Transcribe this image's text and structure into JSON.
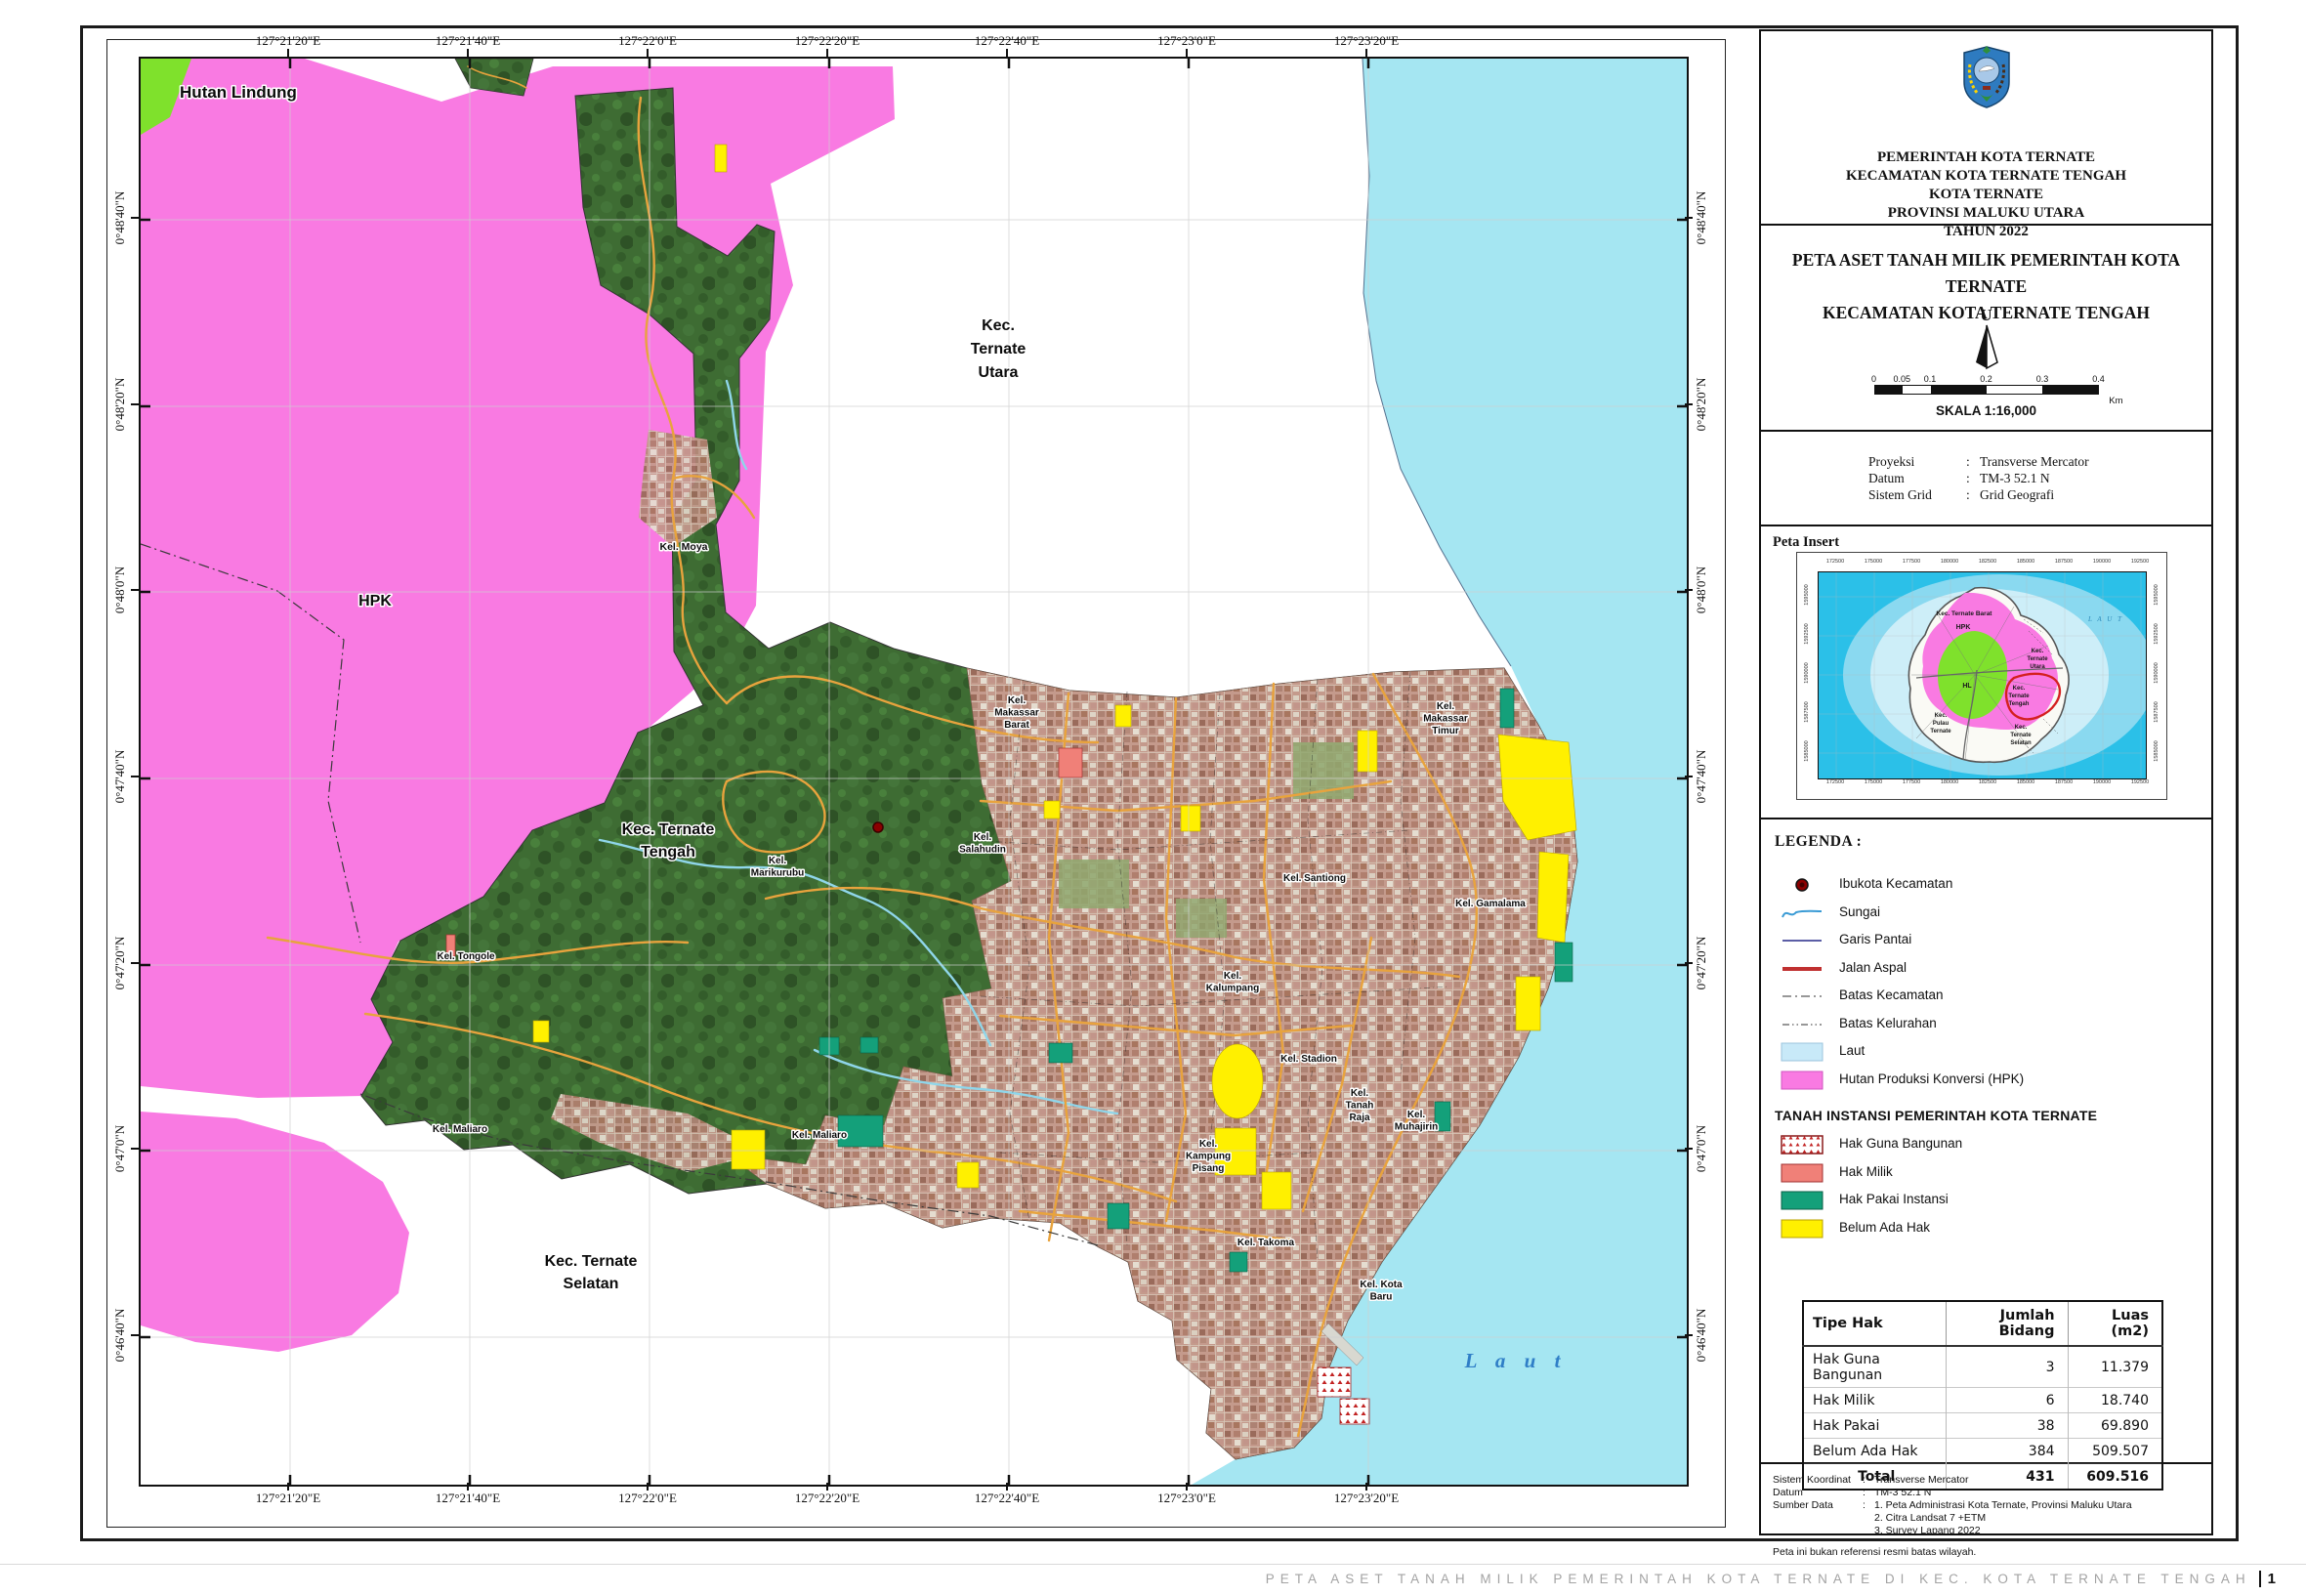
{
  "header": {
    "lines": [
      "PEMERINTAH KOTA TERNATE",
      "KECAMATAN KOTA TERNATE TENGAH",
      "KOTA TERNATE",
      "PROVINSI MALUKU UTARA",
      "TAHUN 2022"
    ]
  },
  "title": {
    "line1": "PETA ASET TANAH MILIK PEMERINTAH KOTA TERNATE",
    "line2": "KECAMATAN KOTA TERNATE TENGAH"
  },
  "north": {
    "label": "U"
  },
  "scalebar": {
    "ticks": [
      "0",
      "0.05",
      "0.1",
      "0.2",
      "0.3",
      "0.4"
    ],
    "unit": "Km",
    "skala": "SKALA 1:16,000"
  },
  "projection": {
    "rows": [
      {
        "label": "Proyeksi",
        "value": "Transverse Mercator"
      },
      {
        "label": "Datum",
        "value": "TM-3 52.1 N"
      },
      {
        "label": "Sistem Grid",
        "value": "Grid Geografi"
      }
    ]
  },
  "inset": {
    "heading": "Peta Insert",
    "sea_label": "L A U T",
    "x_ticks": [
      "172500",
      "175000",
      "177500",
      "180000",
      "182500",
      "185000",
      "187500",
      "190000",
      "192500"
    ],
    "y_ticks": [
      "1595000",
      "1592500",
      "1590000",
      "1587500",
      "1585000"
    ],
    "labels": [
      {
        "lines": [
          "Kec. Ternate Barat"
        ],
        "x": 149,
        "y": 44,
        "size": 6.5,
        "bold": true
      },
      {
        "lines": [
          "HPK"
        ],
        "x": 148,
        "y": 58,
        "size": 7,
        "bold": true
      },
      {
        "lines": [
          "Kec.",
          "Ternate",
          "Utara"
        ],
        "x": 224,
        "y": 82,
        "size": 6,
        "bold": true
      },
      {
        "lines": [
          "HL"
        ],
        "x": 152,
        "y": 118,
        "size": 7,
        "bold": true
      },
      {
        "lines": [
          "Kec.",
          "Ternate",
          "Tengah"
        ],
        "x": 205,
        "y": 120,
        "size": 6,
        "bold": true
      },
      {
        "lines": [
          "Kec.",
          "Pulau",
          "Ternate"
        ],
        "x": 125,
        "y": 148,
        "size": 6,
        "bold": true
      },
      {
        "lines": [
          "Kec.",
          "Ternate",
          "Selatan"
        ],
        "x": 207,
        "y": 160,
        "size": 6,
        "bold": true
      }
    ]
  },
  "legend": {
    "heading": "LEGENDA :",
    "items": [
      {
        "label": "Ibukota Kecamatan",
        "sym": "point"
      },
      {
        "label": "Sungai",
        "sym": "river"
      },
      {
        "label": "Garis Pantai",
        "sym": "coast"
      },
      {
        "label": "Jalan Aspal",
        "sym": "road"
      },
      {
        "label": "Batas Kecamatan",
        "sym": "dash1"
      },
      {
        "label": "Batas Kelurahan",
        "sym": "dash2"
      },
      {
        "label": "Laut",
        "sym": "fill",
        "color": "#c8e9f8",
        "border": "#9bc4dd"
      },
      {
        "label": "Hutan Produksi Konversi (HPK)",
        "sym": "fill",
        "color": "#f97ae2",
        "border": "#d055c0"
      }
    ],
    "tanah_heading": "TANAH INSTANSI PEMERINTAH KOTA TERNATE",
    "tanah_items": [
      {
        "label": "Hak Guna Bangunan",
        "sym": "hgb",
        "color": "#ffffff",
        "border": "#8b1a1a"
      },
      {
        "label": "Hak Milik",
        "sym": "fill",
        "color": "#f08078",
        "border": "#a03030"
      },
      {
        "label": "Hak Pakai Instansi",
        "sym": "fill",
        "color": "#14a07a",
        "border": "#0a5f47"
      },
      {
        "label": "Belum Ada Hak",
        "sym": "fill",
        "color": "#fff000",
        "border": "#b8a000"
      }
    ]
  },
  "table": {
    "headers": [
      "Tipe Hak",
      "Jumlah Bidang",
      "Luas (m2)"
    ],
    "rows": [
      [
        "Hak Guna Bangunan",
        "3",
        "11.379"
      ],
      [
        "Hak Milik",
        "6",
        "18.740"
      ],
      [
        "Hak Pakai",
        "38",
        "69.890"
      ],
      [
        "Belum Ada Hak",
        "384",
        "509.507"
      ]
    ],
    "total": [
      "Total",
      "431",
      "609.516"
    ]
  },
  "info": {
    "rows": [
      {
        "label": "Sistem Koordinat",
        "value": "Transverse Mercator"
      },
      {
        "label": "Datum",
        "value": "TM-3 52.1 N"
      },
      {
        "label": "Sumber Data",
        "value": "1. Peta Administrasi Kota Ternate, Provinsi Maluku Utara\n2. Citra Landsat 7 +ETM\n3. Survey Lapang 2022"
      }
    ],
    "note": "Peta ini bukan referensi resmi batas wilayah."
  },
  "map": {
    "lon_labels": [
      "127°21'20\"E",
      "127°21'40\"E",
      "127°22'0\"E",
      "127°22'20\"E",
      "127°22'40\"E",
      "127°23'0\"E",
      "127°23'20\"E"
    ],
    "lat_labels": [
      "0°48'40\"N",
      "0°48'20\"N",
      "0°48'0\"N",
      "0°47'40\"N",
      "0°47'20\"N",
      "0°47'0\"N",
      "0°46'40\"N"
    ],
    "place_labels": [
      {
        "lines": [
          "Hutan Lindung"
        ],
        "x": 100,
        "y": 40,
        "size": 17,
        "bold": true
      },
      {
        "lines": [
          "HPK"
        ],
        "x": 240,
        "y": 560,
        "size": 16,
        "bold": true
      },
      {
        "lines": [
          "Kec.",
          "Ternate",
          "Utara"
        ],
        "x": 878,
        "y": 278,
        "size": 16,
        "bold": true,
        "lh": 24
      },
      {
        "lines": [
          "Kel. Moya"
        ],
        "x": 556,
        "y": 503,
        "size": 10.5
      },
      {
        "lines": [
          "Kec. Ternate",
          "Tengah"
        ],
        "x": 540,
        "y": 794,
        "size": 16,
        "bold": true,
        "lh": 23
      },
      {
        "lines": [
          "Kel.",
          "Marikurubu"
        ],
        "x": 652,
        "y": 824,
        "size": 10
      },
      {
        "lines": [
          "Kel.",
          "Salahudin"
        ],
        "x": 862,
        "y": 800,
        "size": 10
      },
      {
        "lines": [
          "Kel.",
          "Makassar",
          "Barat"
        ],
        "x": 897,
        "y": 660,
        "size": 10
      },
      {
        "lines": [
          "Kel. Santiong"
        ],
        "x": 1202,
        "y": 842,
        "size": 10
      },
      {
        "lines": [
          "Kel. Gamalama"
        ],
        "x": 1382,
        "y": 868,
        "size": 10
      },
      {
        "lines": [
          "Kel.",
          "Makassar",
          "Timur"
        ],
        "x": 1336,
        "y": 666,
        "size": 10
      },
      {
        "lines": [
          "Kel.",
          "Kalumpang"
        ],
        "x": 1118,
        "y": 942,
        "size": 10
      },
      {
        "lines": [
          "Kel. Stadion"
        ],
        "x": 1196,
        "y": 1027,
        "size": 10
      },
      {
        "lines": [
          "Kel.",
          "Tanah",
          "Raja"
        ],
        "x": 1248,
        "y": 1062,
        "size": 10
      },
      {
        "lines": [
          "Kel.",
          "Muhajirin"
        ],
        "x": 1306,
        "y": 1084,
        "size": 10
      },
      {
        "lines": [
          "Kel.",
          "Kampung",
          "Pisang"
        ],
        "x": 1093,
        "y": 1114,
        "size": 10
      },
      {
        "lines": [
          "Kel. Takoma"
        ],
        "x": 1152,
        "y": 1215,
        "size": 10
      },
      {
        "lines": [
          "Kel. Kota",
          "Baru"
        ],
        "x": 1270,
        "y": 1258,
        "size": 10
      },
      {
        "lines": [
          "Kel. Tongole"
        ],
        "x": 333,
        "y": 922,
        "size": 10
      },
      {
        "lines": [
          "Kel. Maliaro"
        ],
        "x": 327,
        "y": 1099,
        "size": 10
      },
      {
        "lines": [
          "Kel. Maliaro"
        ],
        "x": 695,
        "y": 1105,
        "size": 10
      },
      {
        "lines": [
          "Kec. Ternate",
          "Selatan"
        ],
        "x": 461,
        "y": 1236,
        "size": 16,
        "bold": true,
        "lh": 23
      },
      {
        "lines": [
          "L a u t"
        ],
        "x": 1408,
        "y": 1340,
        "size": 21,
        "italic": true,
        "serif": true,
        "color": "#2f7ec7",
        "ls": 7
      }
    ]
  },
  "colors": {
    "hpk_pink": "#f97ae2",
    "hutan_lindung_green": "#7fe12c",
    "sea_cyan": "#a5e6f2",
    "forest_green": "#3e6c33",
    "urban_base": "#c49a8c",
    "road_orange": "#e8a33d",
    "river_blue": "#8fd6ea",
    "belum_ada_hak_yellow": "#fff000",
    "hak_pakai_green": "#14a07a",
    "hak_milik_salmon": "#f08078",
    "hak_guna_bangunan_red": "#8b1a1a",
    "inset_sea_dark": "#2bc0e8",
    "inset_sea_mid": "#8ad9f0",
    "inset_sea_light": "#cdeef8",
    "tengah_boundary_red": "#d42020"
  },
  "footer": {
    "text": "PETA ASET TANAH MILIK PEMERINTAH KOTA TERNATE DI KEC. KOTA TERNATE TENGAH",
    "page": "1"
  }
}
